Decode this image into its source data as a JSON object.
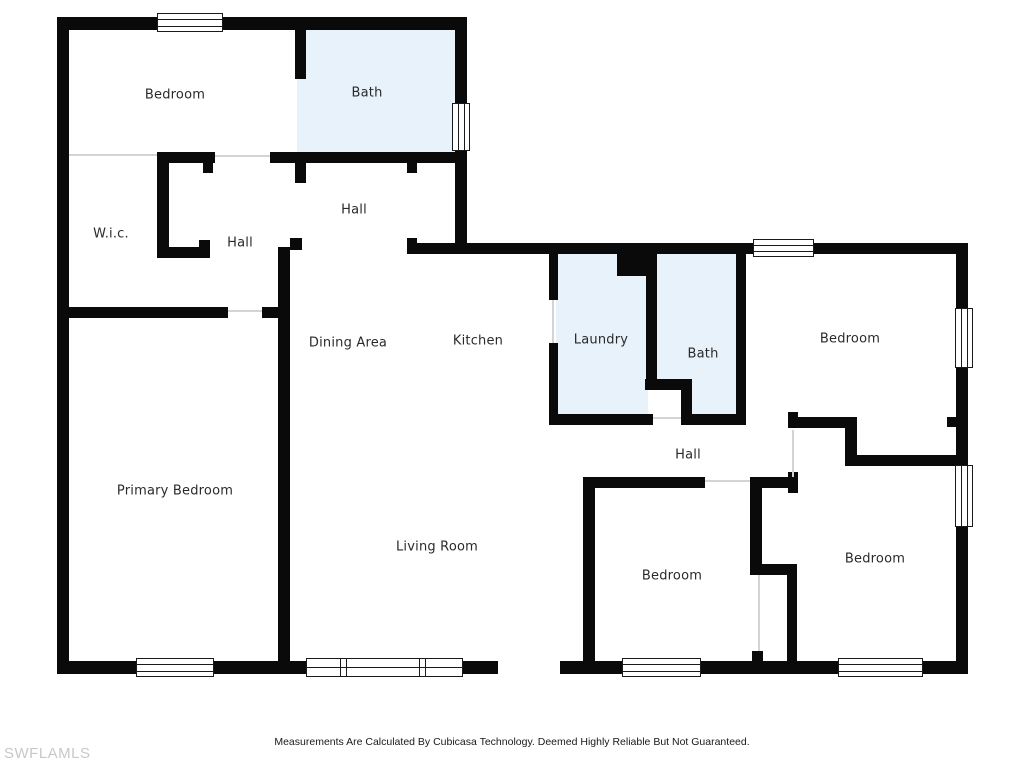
{
  "colors": {
    "wall": "#0a0a0a",
    "wet": "#e7f2fb",
    "open_line": "#d4d4d4",
    "label": "#2a2a2a",
    "watermark": "#c8c8c8",
    "frame": "#1a1a1a"
  },
  "rooms": [
    {
      "id": "bedroom-top-left",
      "label": "Bedroom"
    },
    {
      "id": "bath-top",
      "label": "Bath"
    },
    {
      "id": "wic",
      "label": "W.i.c."
    },
    {
      "id": "hall-left",
      "label": "Hall"
    },
    {
      "id": "hall-center",
      "label": "Hall"
    },
    {
      "id": "dining-area",
      "label": "Dining Area"
    },
    {
      "id": "kitchen",
      "label": "Kitchen"
    },
    {
      "id": "laundry",
      "label": "Laundry"
    },
    {
      "id": "bath-right",
      "label": "Bath"
    },
    {
      "id": "bedroom-right-top",
      "label": "Bedroom"
    },
    {
      "id": "hall-right",
      "label": "Hall"
    },
    {
      "id": "bedroom-bottom-middle",
      "label": "Bedroom"
    },
    {
      "id": "bedroom-bottom-right",
      "label": "Bedroom"
    },
    {
      "id": "primary-bedroom",
      "label": "Primary Bedroom"
    },
    {
      "id": "living-room",
      "label": "Living Room"
    }
  ],
  "footer": {
    "disclaimer": "Measurements Are Calculated By Cubicasa Technology. Deemed Highly Reliable But Not Guaranteed.",
    "watermark": "SWFLAMLS"
  }
}
